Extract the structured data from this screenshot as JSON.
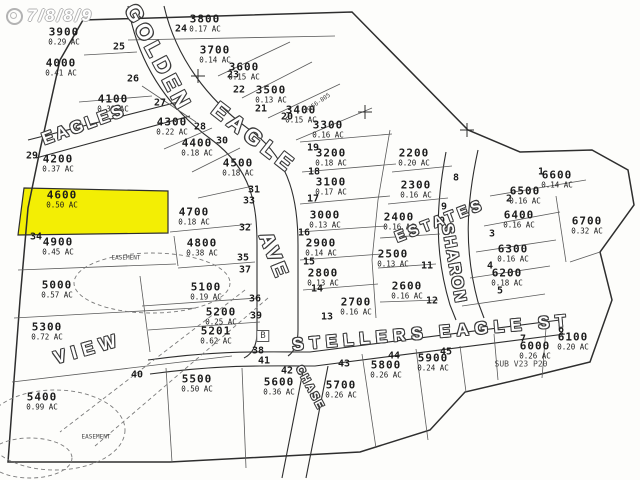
{
  "map": {
    "watermark": {
      "text": "7/8/8/9",
      "icon": "double-circle-logo"
    },
    "highlight": {
      "lot": "4600",
      "color": "#f3ee04"
    },
    "line_color": "#2e2e2e",
    "paper_color": "#fdfdfb",
    "streets": [
      {
        "name": "GOLDEN",
        "x": 158,
        "y": 58,
        "rot": 62,
        "fs": 22,
        "ls": 4
      },
      {
        "name": "EAGLE",
        "x": 254,
        "y": 138,
        "rot": 38,
        "fs": 22,
        "ls": 5
      },
      {
        "name": "AVE",
        "x": 273,
        "y": 256,
        "rot": 68,
        "fs": 20,
        "ls": 3
      },
      {
        "name": "EAGLES",
        "x": 84,
        "y": 125,
        "rot": -20,
        "fs": 17,
        "ls": 3
      },
      {
        "name": "SHARON",
        "x": 453,
        "y": 264,
        "rot": 80,
        "fs": 16,
        "ls": 2
      },
      {
        "name": "ESTATES",
        "x": 440,
        "y": 221,
        "rot": -21,
        "fs": 15,
        "ls": 4
      },
      {
        "name": "STELLERS EAGLE ST",
        "x": 432,
        "y": 333,
        "rot": -5,
        "fs": 17,
        "ls": 6
      },
      {
        "name": "VIEW",
        "x": 88,
        "y": 349,
        "rot": -16,
        "fs": 18,
        "ls": 6
      },
      {
        "name": "CHASE",
        "x": 310,
        "y": 388,
        "rot": 62,
        "fs": 11,
        "ls": 2
      }
    ],
    "lots": [
      {
        "number": "3800",
        "acreage": "0.17 AC",
        "x": 205,
        "y": 23
      },
      {
        "number": "3900",
        "acreage": "0.29 AC",
        "x": 64,
        "y": 36
      },
      {
        "number": "4000",
        "acreage": "0.41 AC",
        "x": 61,
        "y": 67
      },
      {
        "number": "4100",
        "acreage": "0.38 AC",
        "x": 113,
        "y": 103
      },
      {
        "number": "4200",
        "acreage": "0.37 AC",
        "x": 58,
        "y": 163
      },
      {
        "number": "4300",
        "acreage": "0.22 AC",
        "x": 172,
        "y": 126
      },
      {
        "number": "4400",
        "acreage": "0.18 AC",
        "x": 197,
        "y": 147
      },
      {
        "number": "4500",
        "acreage": "0.18 AC",
        "x": 238,
        "y": 167
      },
      {
        "number": "4600",
        "acreage": "0.50 AC",
        "x": 62,
        "y": 199,
        "highlight": true
      },
      {
        "number": "4700",
        "acreage": "0.18 AC",
        "x": 194,
        "y": 216
      },
      {
        "number": "4800",
        "acreage": "0.38 AC",
        "x": 202,
        "y": 247
      },
      {
        "number": "4900",
        "acreage": "0.45 AC",
        "x": 58,
        "y": 246
      },
      {
        "number": "5000",
        "acreage": "0.57 AC",
        "x": 57,
        "y": 289
      },
      {
        "number": "5100",
        "acreage": "0.19 AC",
        "x": 206,
        "y": 291
      },
      {
        "number": "5200",
        "acreage": "0.25 AC",
        "x": 221,
        "y": 316
      },
      {
        "number": "5201",
        "acreage": "0.62 AC",
        "x": 216,
        "y": 335
      },
      {
        "number": "5300",
        "acreage": "0.72 AC",
        "x": 47,
        "y": 331
      },
      {
        "number": "5400",
        "acreage": "0.99 AC",
        "x": 42,
        "y": 401
      },
      {
        "number": "5500",
        "acreage": "0.50 AC",
        "x": 197,
        "y": 383
      },
      {
        "number": "5600",
        "acreage": "0.36 AC",
        "x": 279,
        "y": 386
      },
      {
        "number": "5700",
        "acreage": "0.26 AC",
        "x": 341,
        "y": 389
      },
      {
        "number": "5800",
        "acreage": "0.26 AC",
        "x": 386,
        "y": 369
      },
      {
        "number": "5900",
        "acreage": "0.24 AC",
        "x": 433,
        "y": 362
      },
      {
        "number": "6000",
        "acreage": "0.26 AC",
        "x": 535,
        "y": 350
      },
      {
        "number": "6100",
        "acreage": "0.20 AC",
        "x": 573,
        "y": 341
      },
      {
        "number": "6200",
        "acreage": "0.18 AC",
        "x": 507,
        "y": 277
      },
      {
        "number": "6300",
        "acreage": "0.16 AC",
        "x": 513,
        "y": 253
      },
      {
        "number": "6400",
        "acreage": "0.16 AC",
        "x": 519,
        "y": 219
      },
      {
        "number": "6500",
        "acreage": "0.16 AC",
        "x": 525,
        "y": 195
      },
      {
        "number": "6600",
        "acreage": "0.14 AC",
        "x": 557,
        "y": 179
      },
      {
        "number": "6700",
        "acreage": "0.32 AC",
        "x": 587,
        "y": 225
      },
      {
        "number": "2200",
        "acreage": "0.20 AC",
        "x": 414,
        "y": 157
      },
      {
        "number": "2300",
        "acreage": "0.16 AC",
        "x": 416,
        "y": 189
      },
      {
        "number": "2400",
        "acreage": "0.16 AC",
        "x": 399,
        "y": 221
      },
      {
        "number": "2500",
        "acreage": "0.13 AC",
        "x": 393,
        "y": 258
      },
      {
        "number": "2600",
        "acreage": "0.16 AC",
        "x": 407,
        "y": 290
      },
      {
        "number": "2700",
        "acreage": "0.16 AC",
        "x": 356,
        "y": 306
      },
      {
        "number": "2800",
        "acreage": "0.13 AC",
        "x": 323,
        "y": 277
      },
      {
        "number": "2900",
        "acreage": "0.14 AC",
        "x": 321,
        "y": 247
      },
      {
        "number": "3000",
        "acreage": "0.13 AC",
        "x": 325,
        "y": 219
      },
      {
        "number": "3100",
        "acreage": "0.17 AC",
        "x": 331,
        "y": 186
      },
      {
        "number": "3200",
        "acreage": "0.18 AC",
        "x": 331,
        "y": 157
      },
      {
        "number": "3300",
        "acreage": "0.16 AC",
        "x": 328,
        "y": 129
      },
      {
        "number": "3400",
        "acreage": "0.15 AC",
        "x": 301,
        "y": 114
      },
      {
        "number": "3500",
        "acreage": "0.13 AC",
        "x": 271,
        "y": 94
      },
      {
        "number": "3600",
        "acreage": "0.15 AC",
        "x": 244,
        "y": 71
      },
      {
        "number": "3700",
        "acreage": "0.14 AC",
        "x": 215,
        "y": 54
      }
    ],
    "index_markers": [
      {
        "n": "1",
        "x": 541,
        "y": 172
      },
      {
        "n": "2",
        "x": 509,
        "y": 199
      },
      {
        "n": "3",
        "x": 492,
        "y": 234
      },
      {
        "n": "4",
        "x": 490,
        "y": 266
      },
      {
        "n": "5",
        "x": 500,
        "y": 291
      },
      {
        "n": "6",
        "x": 561,
        "y": 330
      },
      {
        "n": "7",
        "x": 523,
        "y": 339
      },
      {
        "n": "8",
        "x": 456,
        "y": 178
      },
      {
        "n": "9",
        "x": 444,
        "y": 207
      },
      {
        "n": "10",
        "x": 439,
        "y": 221
      },
      {
        "n": "11",
        "x": 427,
        "y": 266
      },
      {
        "n": "12",
        "x": 432,
        "y": 301
      },
      {
        "n": "13",
        "x": 327,
        "y": 317
      },
      {
        "n": "14",
        "x": 317,
        "y": 289
      },
      {
        "n": "15",
        "x": 309,
        "y": 262
      },
      {
        "n": "16",
        "x": 304,
        "y": 233
      },
      {
        "n": "17",
        "x": 313,
        "y": 199
      },
      {
        "n": "18",
        "x": 314,
        "y": 172
      },
      {
        "n": "19",
        "x": 313,
        "y": 148
      },
      {
        "n": "20",
        "x": 287,
        "y": 117
      },
      {
        "n": "21",
        "x": 261,
        "y": 109
      },
      {
        "n": "22",
        "x": 239,
        "y": 90
      },
      {
        "n": "23",
        "x": 233,
        "y": 75
      },
      {
        "n": "24",
        "x": 181,
        "y": 29
      },
      {
        "n": "25",
        "x": 119,
        "y": 47
      },
      {
        "n": "26",
        "x": 133,
        "y": 79
      },
      {
        "n": "27",
        "x": 160,
        "y": 103
      },
      {
        "n": "28",
        "x": 200,
        "y": 127
      },
      {
        "n": "29",
        "x": 32,
        "y": 156
      },
      {
        "n": "30",
        "x": 222,
        "y": 141
      },
      {
        "n": "31",
        "x": 254,
        "y": 190
      },
      {
        "n": "32",
        "x": 245,
        "y": 228
      },
      {
        "n": "33",
        "x": 249,
        "y": 201
      },
      {
        "n": "34",
        "x": 36,
        "y": 237
      },
      {
        "n": "35",
        "x": 243,
        "y": 258
      },
      {
        "n": "36",
        "x": 255,
        "y": 299
      },
      {
        "n": "37",
        "x": 245,
        "y": 270
      },
      {
        "n": "38",
        "x": 258,
        "y": 351
      },
      {
        "n": "39",
        "x": 256,
        "y": 316
      },
      {
        "n": "40",
        "x": 137,
        "y": 375
      },
      {
        "n": "41",
        "x": 264,
        "y": 361
      },
      {
        "n": "42",
        "x": 287,
        "y": 371
      },
      {
        "n": "43",
        "x": 344,
        "y": 364
      },
      {
        "n": "44",
        "x": 394,
        "y": 356
      },
      {
        "n": "45",
        "x": 446,
        "y": 352
      }
    ],
    "annotations": [
      {
        "text": "EASEMENT",
        "x": 126,
        "y": 258,
        "fs": 6
      },
      {
        "text": "EASEMENT",
        "x": 96,
        "y": 437,
        "fs": 6
      },
      {
        "text": "SUB V23 P20",
        "x": 521,
        "y": 364,
        "fs": 8
      },
      {
        "text": "M156-805",
        "x": 318,
        "y": 103,
        "fs": 6,
        "rot": -35
      },
      {
        "text": "B",
        "x": 263,
        "y": 336,
        "fs": 9,
        "boxed": true
      }
    ]
  }
}
